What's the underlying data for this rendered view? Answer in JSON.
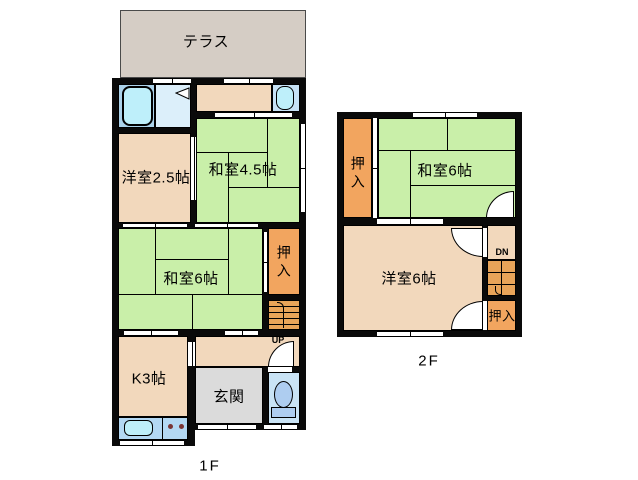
{
  "title": "2-story house floor plan",
  "colors": {
    "wall": "#0a0a0a",
    "tatami_green": "#c9efa9",
    "western_tan": "#f2d8bc",
    "closet_orange": "#f2a55f",
    "stairs_orange": "#e8a459",
    "terrace_gray": "#d5cdc5",
    "entry_gray": "#dbdbdb",
    "bath_blue": "#abd2ea",
    "washroom_blue": "#dceffa",
    "toilet_blue": "#c9e3f5",
    "counter_blue": "#b3d8f3",
    "fixture_cyan": "#beeffa"
  },
  "floor1": {
    "label": "1F",
    "terrace_label": "テラス",
    "western_room_25": "洋室2.5帖",
    "japanese_room_45": "和室4.5帖",
    "japanese_room_6": "和室6帖",
    "closet": "押入",
    "kitchen": "K3帖",
    "entry": "玄関",
    "stairs_up": "UP"
  },
  "floor2": {
    "label": "2F",
    "closet_left": "押入",
    "japanese_room_6": "和室6帖",
    "western_room_6": "洋室6帖",
    "stairs_down": "DN",
    "closet_right": "押入"
  }
}
